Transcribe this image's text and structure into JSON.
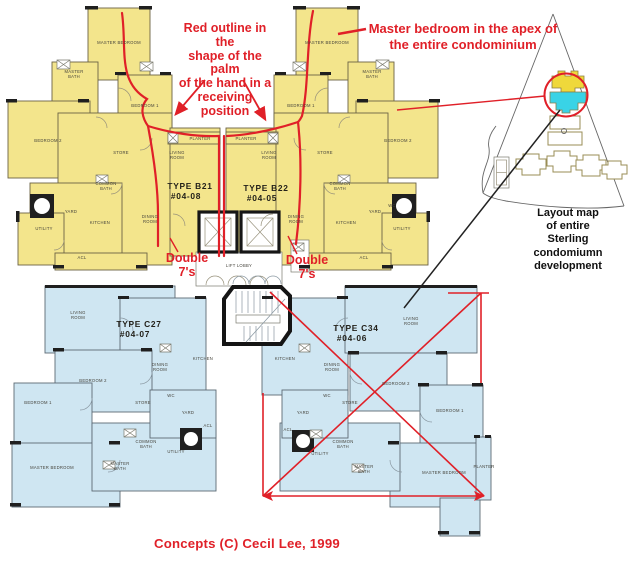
{
  "colors": {
    "unit_fill_yellow": "#F3E58C",
    "unit_fill_blue": "#CFE6F2",
    "annotation_red": "#E02028",
    "map_highlight_yellow": "#EFD83B",
    "map_highlight_cyan": "#39D3E6"
  },
  "annotations": {
    "palm_note_lines": [
      "Red outline in the",
      "shape of the palm",
      "of the hand in a",
      "receiving position"
    ],
    "master_note_lines": [
      "Master bedroom in the apex of",
      "the entire condominium"
    ],
    "double7_left_lines": [
      "Double",
      "7's"
    ],
    "double7_right_lines": [
      "Double",
      "7's"
    ],
    "credit": "Concepts (C)  Cecil Lee, 1999"
  },
  "site_map": {
    "caption_lines": [
      "Layout map",
      "of entire",
      "Sterling",
      "condomiumn",
      "development"
    ]
  },
  "upper_plan": {
    "units": [
      {
        "type": "TYPE B21",
        "unit_no": "#04-08",
        "x": 190,
        "y": 189
      },
      {
        "type": "TYPE B22",
        "unit_no": "#04-05",
        "x": 266,
        "y": 191
      }
    ],
    "room_labels": [
      {
        "t": "MASTER BEDROOM",
        "x": 119,
        "y": 44
      },
      {
        "t": "MASTER BATH",
        "x": 74,
        "y": 73,
        "two": true
      },
      {
        "t": "BEDROOM 1",
        "x": 145,
        "y": 107
      },
      {
        "t": "BEDROOM 2",
        "x": 48,
        "y": 142
      },
      {
        "t": "STORE",
        "x": 121,
        "y": 154
      },
      {
        "t": "LIVING ROOM",
        "x": 177,
        "y": 154,
        "two": true
      },
      {
        "t": "DINING ROOM",
        "x": 150,
        "y": 218,
        "two": true
      },
      {
        "t": "COMMON BATH",
        "x": 106,
        "y": 185,
        "two": true
      },
      {
        "t": "YARD",
        "x": 71,
        "y": 213
      },
      {
        "t": "KITCHEN",
        "x": 100,
        "y": 224
      },
      {
        "t": "UTILITY",
        "x": 44,
        "y": 230
      },
      {
        "t": "ACL",
        "x": 82,
        "y": 259
      },
      {
        "t": "PLANTER",
        "x": 200,
        "y": 140
      },
      {
        "t": "MASTER BEDROOM",
        "x": 327,
        "y": 44
      },
      {
        "t": "MASTER BATH",
        "x": 372,
        "y": 73,
        "two": true
      },
      {
        "t": "BEDROOM 1",
        "x": 301,
        "y": 107
      },
      {
        "t": "BEDROOM 2",
        "x": 398,
        "y": 142
      },
      {
        "t": "STORE",
        "x": 325,
        "y": 154
      },
      {
        "t": "LIVING ROOM",
        "x": 269,
        "y": 154,
        "two": true
      },
      {
        "t": "DINING ROOM",
        "x": 296,
        "y": 218,
        "two": true
      },
      {
        "t": "COMMON BATH",
        "x": 340,
        "y": 185,
        "two": true
      },
      {
        "t": "YARD",
        "x": 375,
        "y": 213
      },
      {
        "t": "KITCHEN",
        "x": 346,
        "y": 224
      },
      {
        "t": "UTILITY",
        "x": 402,
        "y": 230
      },
      {
        "t": "ACL",
        "x": 364,
        "y": 259
      },
      {
        "t": "PLANTER",
        "x": 246,
        "y": 140
      },
      {
        "t": "WC",
        "x": 392,
        "y": 207
      },
      {
        "t": "LIFT LOBBY",
        "x": 239,
        "y": 267
      }
    ]
  },
  "lower_plan": {
    "units": [
      {
        "type": "TYPE C27",
        "unit_no": "#04-07",
        "x": 139,
        "y": 327
      },
      {
        "type": "TYPE C34",
        "unit_no": "#04-06",
        "x": 356,
        "y": 331
      }
    ],
    "room_labels": [
      {
        "t": "LIVING ROOM",
        "x": 78,
        "y": 314,
        "two": true
      },
      {
        "t": "BEDROOM 2",
        "x": 93,
        "y": 382
      },
      {
        "t": "BEDROOM 1",
        "x": 38,
        "y": 404
      },
      {
        "t": "DINING ROOM",
        "x": 160,
        "y": 366,
        "two": true
      },
      {
        "t": "KITCHEN",
        "x": 203,
        "y": 360
      },
      {
        "t": "STORE",
        "x": 143,
        "y": 404
      },
      {
        "t": "WC",
        "x": 171,
        "y": 397
      },
      {
        "t": "YARD",
        "x": 188,
        "y": 414
      },
      {
        "t": "ACL",
        "x": 208,
        "y": 427
      },
      {
        "t": "COMMON BATH",
        "x": 146,
        "y": 443,
        "two": true
      },
      {
        "t": "UTILITY",
        "x": 176,
        "y": 453
      },
      {
        "t": "MASTER BATH",
        "x": 120,
        "y": 465,
        "two": true
      },
      {
        "t": "MASTER BEDROOM",
        "x": 52,
        "y": 469
      },
      {
        "t": "KITCHEN",
        "x": 285,
        "y": 360
      },
      {
        "t": "DINING ROOM",
        "x": 332,
        "y": 366,
        "two": true
      },
      {
        "t": "LIVING ROOM",
        "x": 411,
        "y": 320,
        "two": true
      },
      {
        "t": "BEDROOM 2",
        "x": 396,
        "y": 385
      },
      {
        "t": "BEDROOM 1",
        "x": 450,
        "y": 412
      },
      {
        "t": "STORE",
        "x": 350,
        "y": 404
      },
      {
        "t": "WC",
        "x": 327,
        "y": 397
      },
      {
        "t": "YARD",
        "x": 303,
        "y": 414
      },
      {
        "t": "ACL",
        "x": 288,
        "y": 431
      },
      {
        "t": "UTILITY",
        "x": 320,
        "y": 455
      },
      {
        "t": "COMMON BATH",
        "x": 343,
        "y": 443,
        "two": true
      },
      {
        "t": "MASTER BATH",
        "x": 364,
        "y": 468,
        "two": true
      },
      {
        "t": "MASTER BEDROOM",
        "x": 444,
        "y": 474
      },
      {
        "t": "PLANTER",
        "x": 484,
        "y": 468
      }
    ]
  }
}
